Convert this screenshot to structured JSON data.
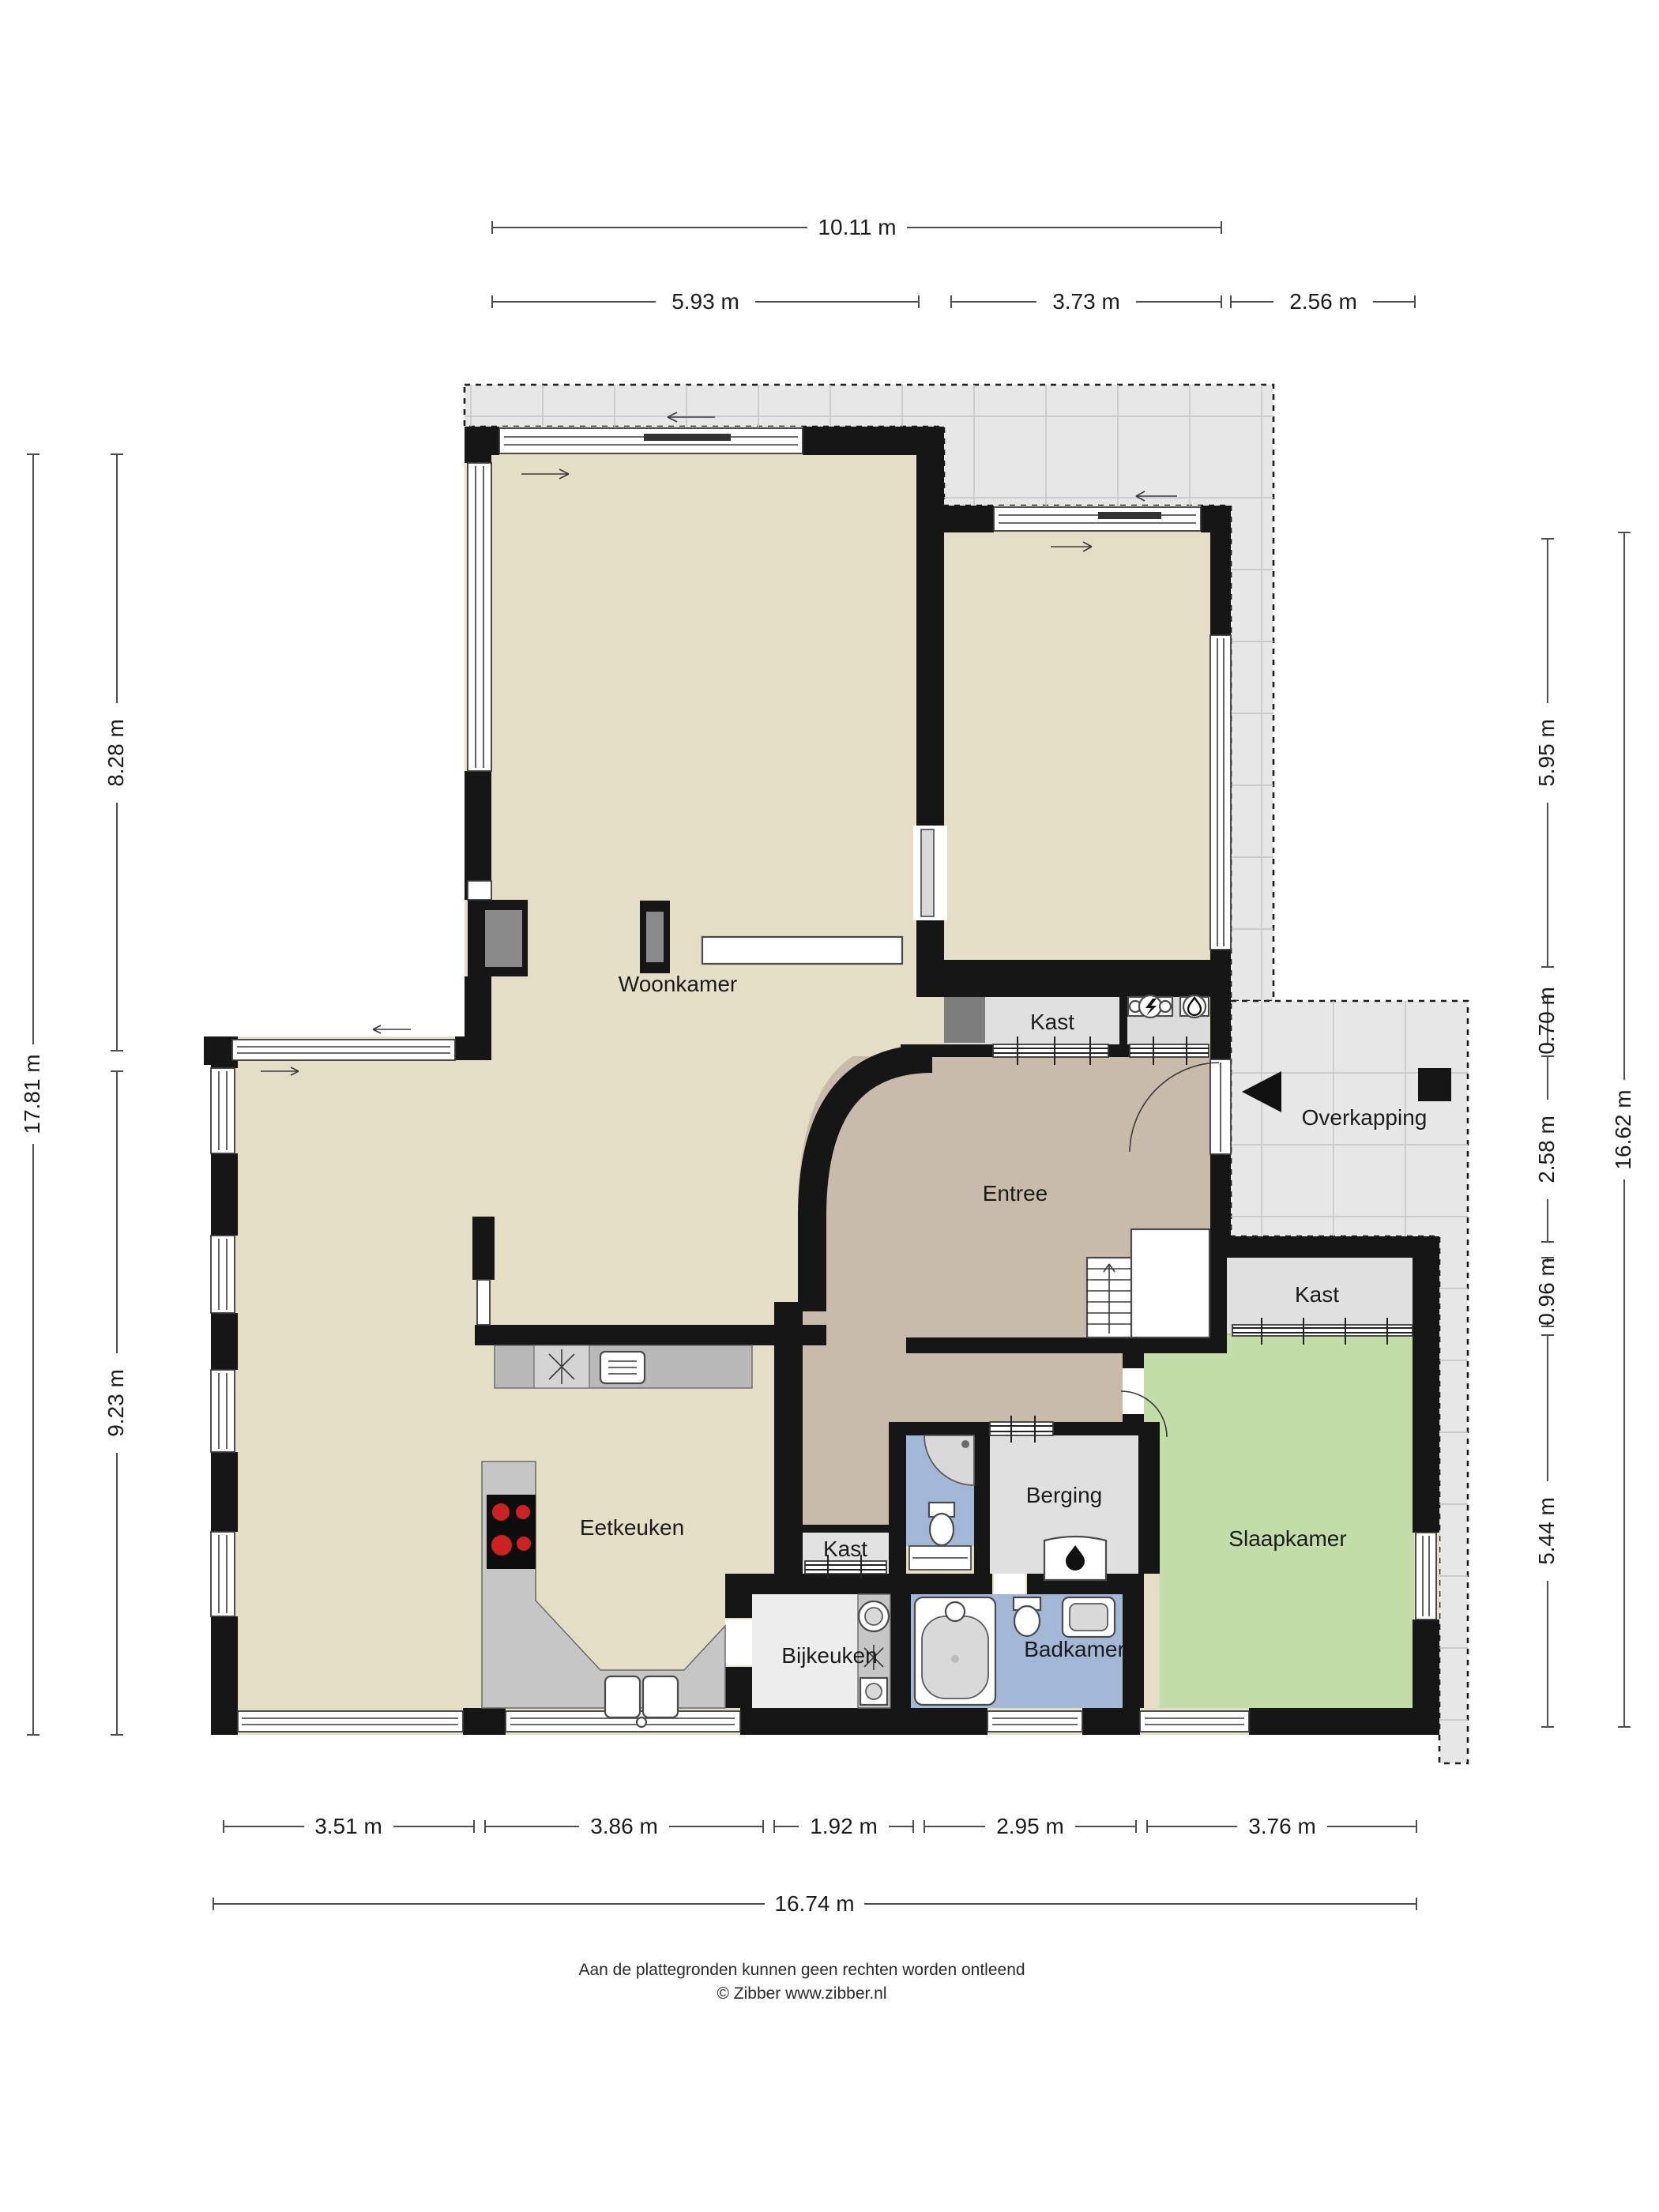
{
  "floorplan": {
    "rooms": {
      "woonkamer": "Woonkamer",
      "eetkeuken": "Eetkeuken",
      "entree": "Entree",
      "overkapping": "Overkapping",
      "slaapkamer": "Slaapkamer",
      "badkamer": "Badkamer",
      "berging": "Berging",
      "bijkeuken": "Bijkeuken",
      "kast_hal": "Kast",
      "kast_slaapkamer": "Kast",
      "kast_gang": "Kast"
    },
    "dimensions": {
      "top_total": "10.11 m",
      "top": [
        "5.93 m",
        "3.73 m",
        "2.56 m"
      ],
      "left_total": "17.81 m",
      "left": [
        "8.28 m",
        "9.23 m"
      ],
      "right": [
        "5.95 m",
        "0.70 m",
        "2.58 m",
        "0.96 m",
        "5.44 m"
      ],
      "right_total": "16.62 m",
      "bottom": [
        "3.51 m",
        "3.86 m",
        "1.92 m",
        "2.95 m",
        "3.76 m"
      ],
      "bottom_total": "16.74 m"
    },
    "footer": {
      "disclaimer": "Aan de plattegronden kunnen geen rechten worden ontleend",
      "copyright": "© Zibber www.zibber.nl"
    },
    "colors": {
      "floor_living": "#e5dec6",
      "floor_hall": "#c9bba9",
      "floor_wet": "#a3b8d6",
      "floor_bedroom": "#c3dda9",
      "floor_storage": "#e0e0e0",
      "terrace": "#e7e7e7",
      "wall": "#161616",
      "cooktop_burner": "#cc2222"
    }
  }
}
